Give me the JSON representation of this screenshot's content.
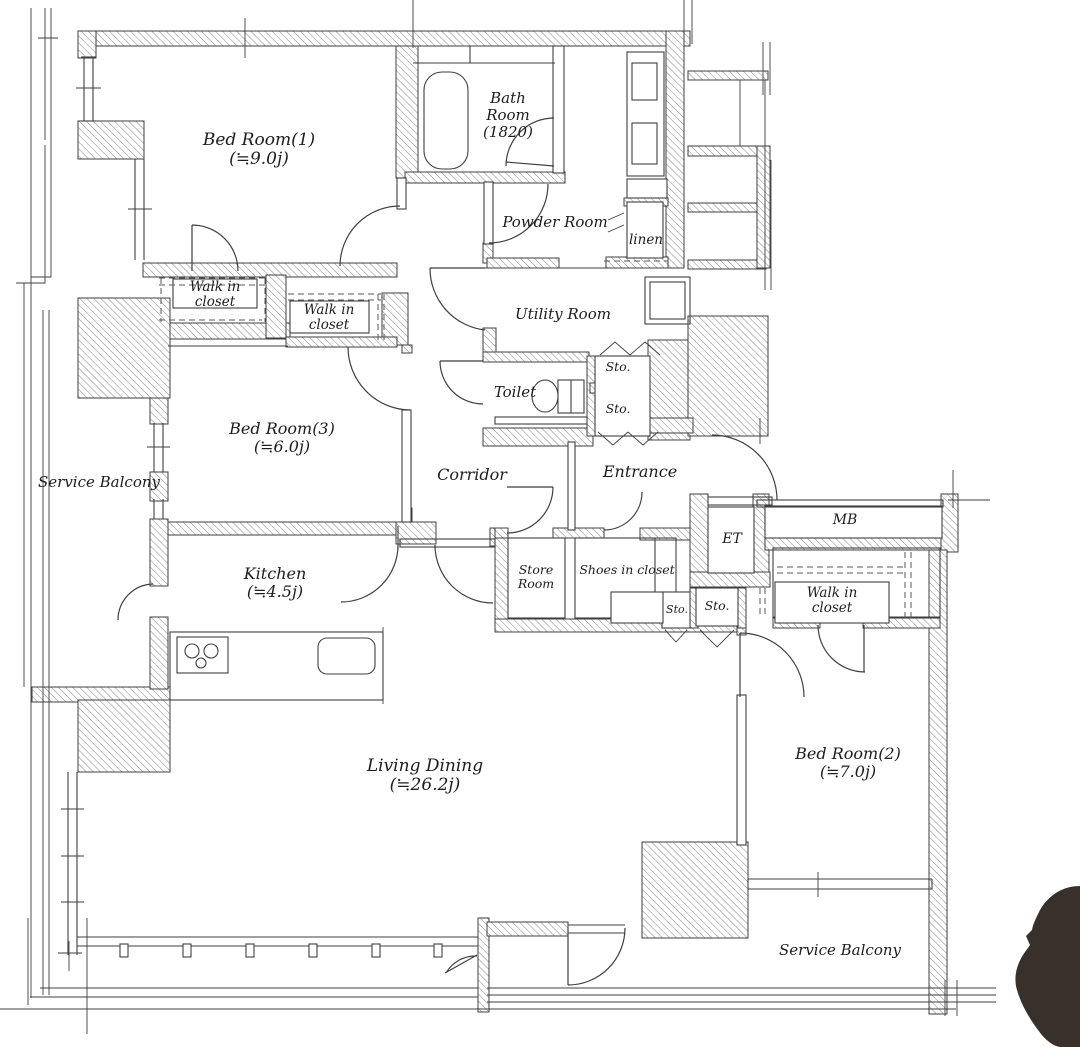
{
  "plan": {
    "rooms": {
      "bedroom1": {
        "name": "Bed Room(1)",
        "size": "(≒9.0j)"
      },
      "bedroom2": {
        "name": "Bed Room(2)",
        "size": "(≒7.0j)"
      },
      "bedroom3": {
        "name": "Bed Room(3)",
        "size": "(≒6.0j)"
      },
      "living_dining": {
        "name": "Living Dining",
        "size": "(≒26.2j)"
      },
      "kitchen": {
        "name": "Kitchen",
        "size": "(≒4.5j)"
      },
      "bathroom": {
        "line1": "Bath",
        "line2": "Room",
        "line3": "(1820)"
      },
      "powder_room": {
        "name": "Powder Room"
      },
      "utility_room": {
        "name": "Utility Room"
      },
      "toilet": {
        "name": "Toilet"
      },
      "corridor": {
        "name": "Corridor"
      },
      "entrance": {
        "name": "Entrance"
      },
      "linen": {
        "name": "linen"
      },
      "walk_in_closet_1": {
        "line1": "Walk in",
        "line2": "closet"
      },
      "walk_in_closet_2": {
        "line1": "Walk in",
        "line2": "closet"
      },
      "walk_in_closet_3": {
        "line1": "Walk in",
        "line2": "closet"
      },
      "store_room": {
        "line1": "Store",
        "line2": "Room"
      },
      "shoes_in_closet": {
        "name": "Shoes in closet"
      },
      "storage_utility_1": {
        "name": "Sto."
      },
      "storage_utility_2": {
        "name": "Sto."
      },
      "storage_entrance_1": {
        "name": "Sto."
      },
      "storage_entrance_2": {
        "name": "Sto."
      },
      "et": {
        "name": "ET"
      },
      "mb": {
        "name": "MB"
      },
      "service_balcony_left": {
        "name": "Service Balcony"
      },
      "service_balcony_right": {
        "name": "Service Balcony"
      }
    },
    "colors": {
      "wall_line": "#3f3f3f",
      "hatch": "#8a8a8a",
      "text": "#1d1d1d",
      "paper": "#ffffff",
      "corner_blob": "#38302b"
    }
  }
}
